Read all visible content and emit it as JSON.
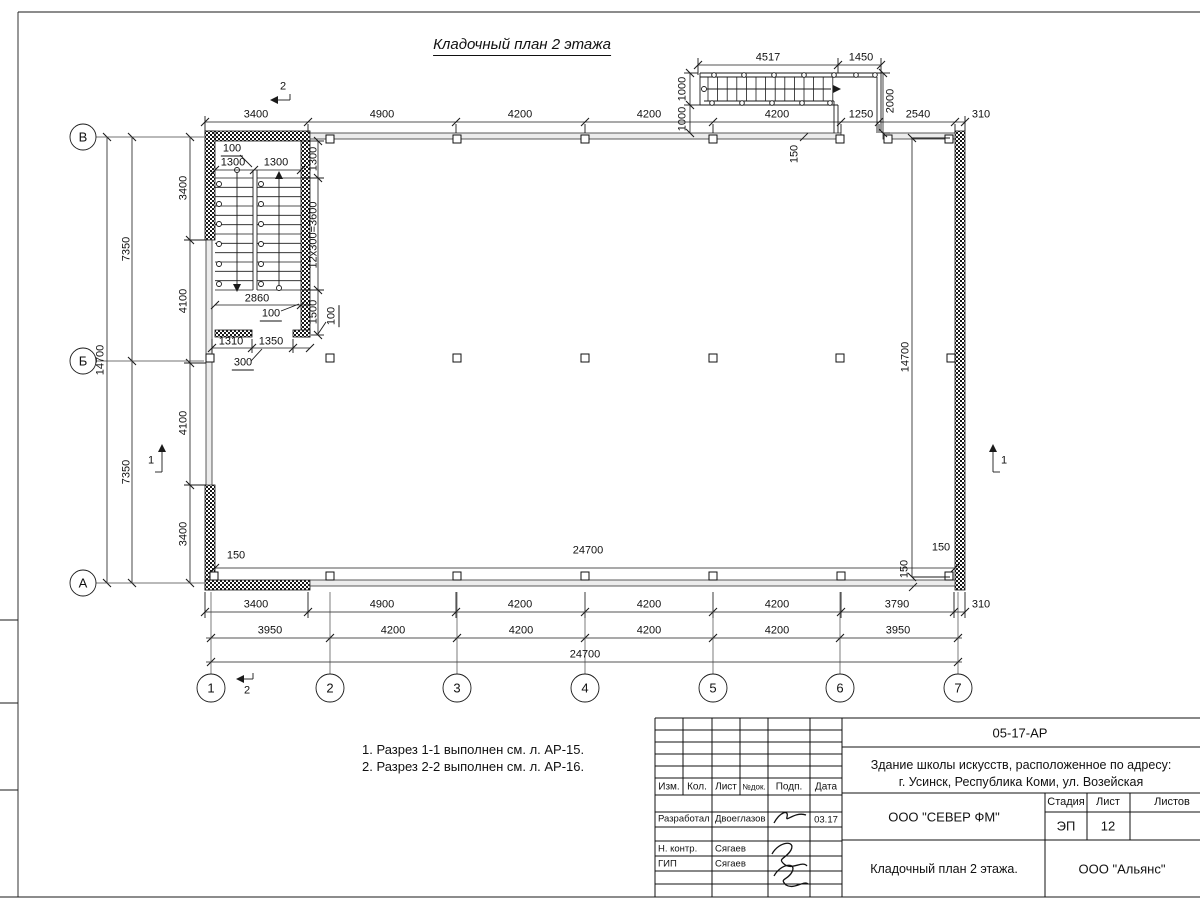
{
  "sheet": {
    "title": "Кладочный план 2 этажа",
    "notes": [
      "1. Разрез 1-1 выполнен см. л. АР-15.",
      "2. Разрез 2-2 выполнен см. л. АР-16."
    ]
  },
  "axes": {
    "columns": [
      {
        "label": "1",
        "x": 211
      },
      {
        "label": "2",
        "x": 330
      },
      {
        "label": "3",
        "x": 457
      },
      {
        "label": "4",
        "x": 585
      },
      {
        "label": "5",
        "x": 713
      },
      {
        "label": "6",
        "x": 840
      },
      {
        "label": "7",
        "x": 958
      }
    ],
    "rows": [
      {
        "label": "В",
        "y": 137
      },
      {
        "label": "Б",
        "y": 361
      },
      {
        "label": "А",
        "y": 583
      }
    ]
  },
  "dim_labels": [
    {
      "t": "4517",
      "x": 768,
      "y": 58
    },
    {
      "t": "1450",
      "x": 861,
      "y": 58
    },
    {
      "t": "1000",
      "x": 683,
      "y": 89,
      "r": 1
    },
    {
      "t": "1000",
      "x": 683,
      "y": 119,
      "r": 1
    },
    {
      "t": "2000",
      "x": 891,
      "y": 101,
      "r": 1
    },
    {
      "t": "150",
      "x": 795,
      "y": 154,
      "r": 1
    },
    {
      "t": "3400",
      "x": 256,
      "y": 115
    },
    {
      "t": "4900",
      "x": 382,
      "y": 115
    },
    {
      "t": "4200",
      "x": 520,
      "y": 115
    },
    {
      "t": "4200",
      "x": 649,
      "y": 115
    },
    {
      "t": "4200",
      "x": 777,
      "y": 115
    },
    {
      "t": "1250",
      "x": 861,
      "y": 115
    },
    {
      "t": "2540",
      "x": 918,
      "y": 115
    },
    {
      "t": "310",
      "x": 981,
      "y": 115
    },
    {
      "t": "100",
      "x": 232,
      "y": 150,
      "u": 1
    },
    {
      "t": "1300",
      "x": 233,
      "y": 163
    },
    {
      "t": "1300",
      "x": 276,
      "y": 163
    },
    {
      "t": "1300",
      "x": 314,
      "y": 159,
      "r": 1
    },
    {
      "t": "12х300=3600",
      "x": 314,
      "y": 235,
      "r": 1
    },
    {
      "t": "2860",
      "x": 257,
      "y": 299
    },
    {
      "t": "100",
      "x": 271,
      "y": 315,
      "u": 1
    },
    {
      "t": "1500",
      "x": 314,
      "y": 312,
      "r": 1
    },
    {
      "t": "100",
      "x": 333,
      "y": 316,
      "r": 1,
      "u": 1
    },
    {
      "t": "1310",
      "x": 231,
      "y": 342
    },
    {
      "t": "1350",
      "x": 271,
      "y": 342
    },
    {
      "t": "300",
      "x": 243,
      "y": 364,
      "u": 1
    },
    {
      "t": "3400",
      "x": 184,
      "y": 188,
      "r": 1
    },
    {
      "t": "4100",
      "x": 184,
      "y": 301,
      "r": 1
    },
    {
      "t": "4100",
      "x": 184,
      "y": 423,
      "r": 1
    },
    {
      "t": "3400",
      "x": 184,
      "y": 534,
      "r": 1
    },
    {
      "t": "7350",
      "x": 127,
      "y": 249,
      "r": 1
    },
    {
      "t": "7350",
      "x": 127,
      "y": 472,
      "r": 1
    },
    {
      "t": "14700",
      "x": 101,
      "y": 360,
      "r": 1
    },
    {
      "t": "14700",
      "x": 906,
      "y": 357,
      "r": 1
    },
    {
      "t": "150",
      "x": 236,
      "y": 556
    },
    {
      "t": "24700",
      "x": 588,
      "y": 551
    },
    {
      "t": "150",
      "x": 941,
      "y": 548
    },
    {
      "t": "150",
      "x": 905,
      "y": 569,
      "r": 1
    },
    {
      "t": "3400",
      "x": 256,
      "y": 605
    },
    {
      "t": "4900",
      "x": 382,
      "y": 605
    },
    {
      "t": "4200",
      "x": 520,
      "y": 605
    },
    {
      "t": "4200",
      "x": 649,
      "y": 605
    },
    {
      "t": "4200",
      "x": 777,
      "y": 605
    },
    {
      "t": "3790",
      "x": 897,
      "y": 605
    },
    {
      "t": "310",
      "x": 981,
      "y": 605
    },
    {
      "t": "3950",
      "x": 270,
      "y": 631
    },
    {
      "t": "4200",
      "x": 393,
      "y": 631
    },
    {
      "t": "4200",
      "x": 521,
      "y": 631
    },
    {
      "t": "4200",
      "x": 649,
      "y": 631
    },
    {
      "t": "4200",
      "x": 777,
      "y": 631
    },
    {
      "t": "3950",
      "x": 898,
      "y": 631
    },
    {
      "t": "24700",
      "x": 585,
      "y": 655
    },
    {
      "t": "2",
      "x": 283,
      "y": 87
    },
    {
      "t": "2",
      "x": 247,
      "y": 691
    },
    {
      "t": "1",
      "x": 151,
      "y": 461
    },
    {
      "t": "1",
      "x": 1004,
      "y": 461
    }
  ],
  "title_block": {
    "doc_number": "05-17-АР",
    "project_line1": "Здание школы искусств, расположенное по адресу:",
    "project_line2": "г. Усинск, Республика Коми, ул. Возейская",
    "col_izm": "Изм.",
    "col_kol": "Кол.",
    "col_list": "Лист",
    "col_doc": "№док.",
    "col_podp": "Подп.",
    "col_data": "Дата",
    "row1_role": "Разработал",
    "row1_name": "Двоеглазов",
    "row1_date": "03.17",
    "row2_role": "Н. контр.",
    "row2_name": "Сягаев",
    "row3_role": "ГИП",
    "row3_name": "Сягаев",
    "stage_label": "Стадия",
    "sheet_label": "Лист",
    "sheets_label": "Листов",
    "stage": "ЭП",
    "sheet_num": "12",
    "org": "ООО \"СЕВЕР ФМ\"",
    "drawing_title": "Кладочный план 2 этажа.",
    "org2": "ООО \"Альянс\""
  }
}
